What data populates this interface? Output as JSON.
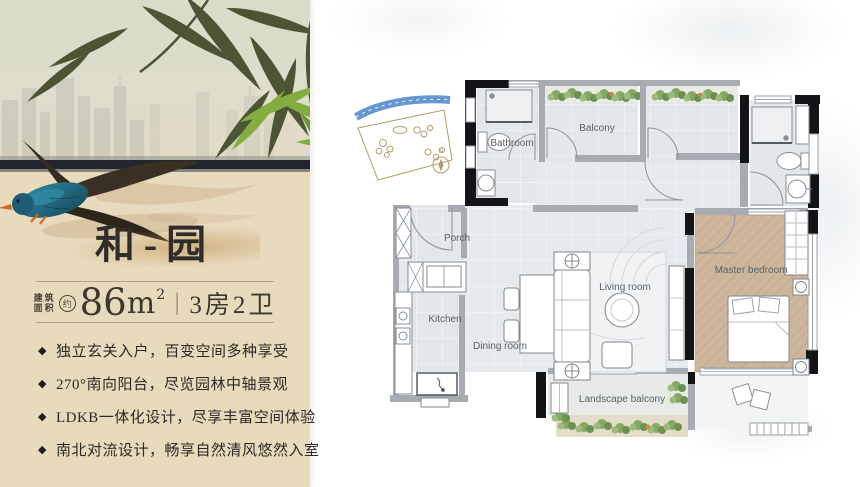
{
  "left_panel": {
    "title": "和-园",
    "area": {
      "label_top": "建筑",
      "label_bottom": "面积",
      "approx": "约",
      "value": "86",
      "unit": "m",
      "unit_sup": "2",
      "separator": "|",
      "rooms": "3房2卫"
    },
    "bullet_glyph": "◆",
    "features": [
      "独立玄关入户，百变空间多种享受",
      "270°南向阳台，尽览园林中轴景观",
      "LDKB一体化设计，尽享丰富空间体验",
      "南北对流设计，畅享自然清风悠然入室"
    ]
  },
  "floor_plan": {
    "rooms": [
      {
        "name": "bathroom",
        "label": "Bathroom"
      },
      {
        "name": "balcony",
        "label": "Balcony"
      },
      {
        "name": "porch",
        "label": "Porch"
      },
      {
        "name": "kitchen",
        "label": "Kitchen"
      },
      {
        "name": "dining-room",
        "label": "Dining room"
      },
      {
        "name": "living-room",
        "label": "Living room"
      },
      {
        "name": "master-bedroom",
        "label": "Master bedroom"
      },
      {
        "name": "landscape-balcony",
        "label": "Landscape balcony"
      }
    ],
    "compass": "N"
  },
  "watermark": {
    "text": "搜狐号@搜狐焦点韶关站"
  },
  "colors": {
    "panel_bg": "#e8dabd",
    "accent_tan": "#be9250",
    "horizon_band": "#20262c",
    "bamboo_dark": "#4c5433",
    "bamboo_green": "#83ad3e",
    "bird_teal": "#226e86",
    "beak_orange": "#d06a1e",
    "wall_gray": "#a6acb1",
    "wall_black": "#121417",
    "room_fill": "#e4e7ea",
    "wood_floor": "#cdb69c",
    "foliage_green": "#87a765",
    "label_gray": "#5b6066",
    "watermark_black": "#0e0e0e"
  }
}
